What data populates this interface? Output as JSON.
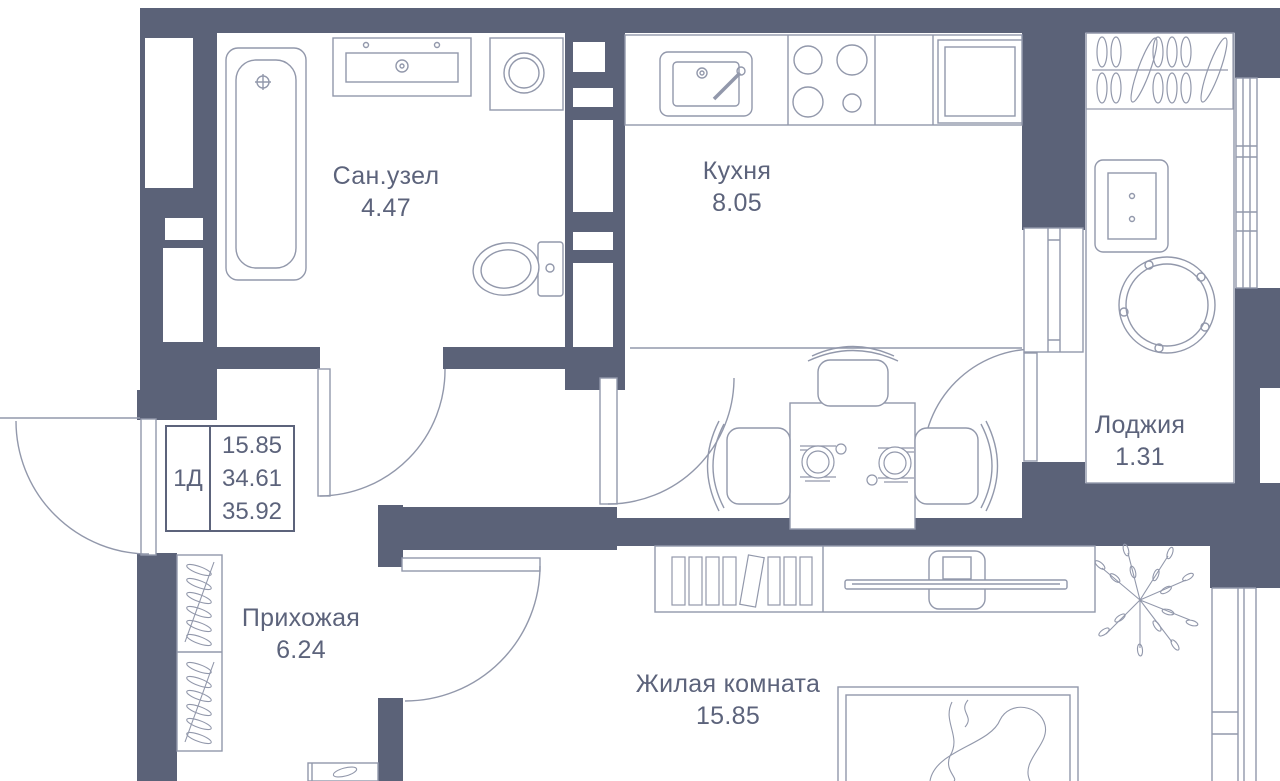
{
  "colors": {
    "wall": "#5b6278",
    "line": "#9298ab",
    "text": "#5c637b",
    "bg": "#ffffff"
  },
  "apartment_card": {
    "type_label": "1Д",
    "living_area": "15.85",
    "apartment_area": "34.61",
    "total_area": "35.92"
  },
  "rooms": {
    "bathroom": {
      "name": "Сан.узел",
      "area": "4.47"
    },
    "kitchen": {
      "name": "Кухня",
      "area": "8.05"
    },
    "loggia": {
      "name": "Лоджия",
      "area": "1.31"
    },
    "hallway": {
      "name": "Прихожая",
      "area": "6.24"
    },
    "living_room": {
      "name": "Жилая комната",
      "area": "15.85"
    }
  },
  "furniture": [
    "bathtub",
    "vanity-sink",
    "washing-machine",
    "toilet",
    "kitchen-sink",
    "stove",
    "fridge",
    "dining-table",
    "chairs",
    "place-settings",
    "hanger-rack",
    "armchair",
    "round-table",
    "bookshelf",
    "tv",
    "plant",
    "bed",
    "wardrobe-hangers",
    "shoe-cabinet",
    "windows",
    "door-swings"
  ]
}
